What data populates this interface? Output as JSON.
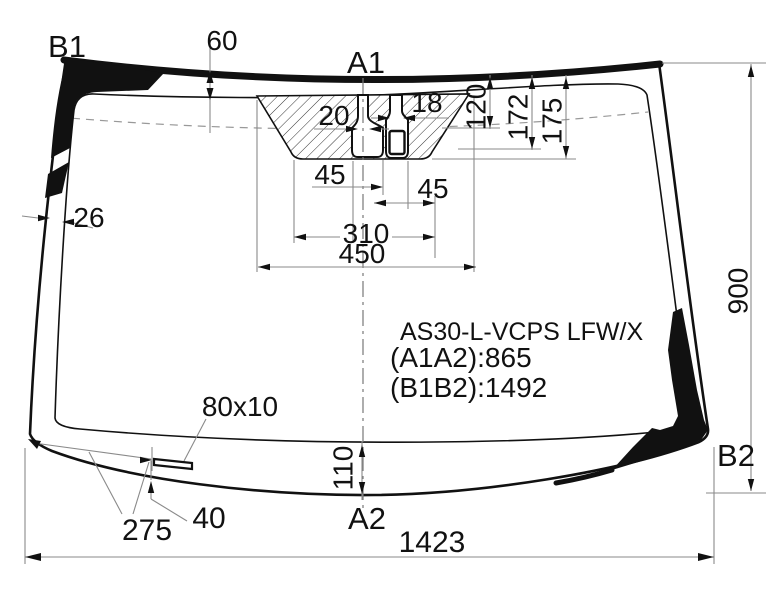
{
  "diagram": {
    "labels": {
      "b1": "B1",
      "a1": "A1",
      "a2": "A2",
      "b2": "B2"
    },
    "part": {
      "code": "AS30-L-VCPS LFW/X",
      "a1a2": "(A1A2):865",
      "b1b2": "(B1B2):1492"
    },
    "dims": {
      "top_band": "60",
      "slot_left": "20",
      "slot_right": "18",
      "depth_120": "120",
      "depth_172": "172",
      "depth_175": "175",
      "offset_45_left": "45",
      "offset_45_right": "45",
      "edge_band": "26",
      "bracket_310": "310",
      "bracket_450": "450",
      "height_900": "900",
      "bottom_band": "110",
      "moulding": "80x10",
      "corner_275": "275",
      "gap_40": "40",
      "width_1423": "1423"
    }
  }
}
